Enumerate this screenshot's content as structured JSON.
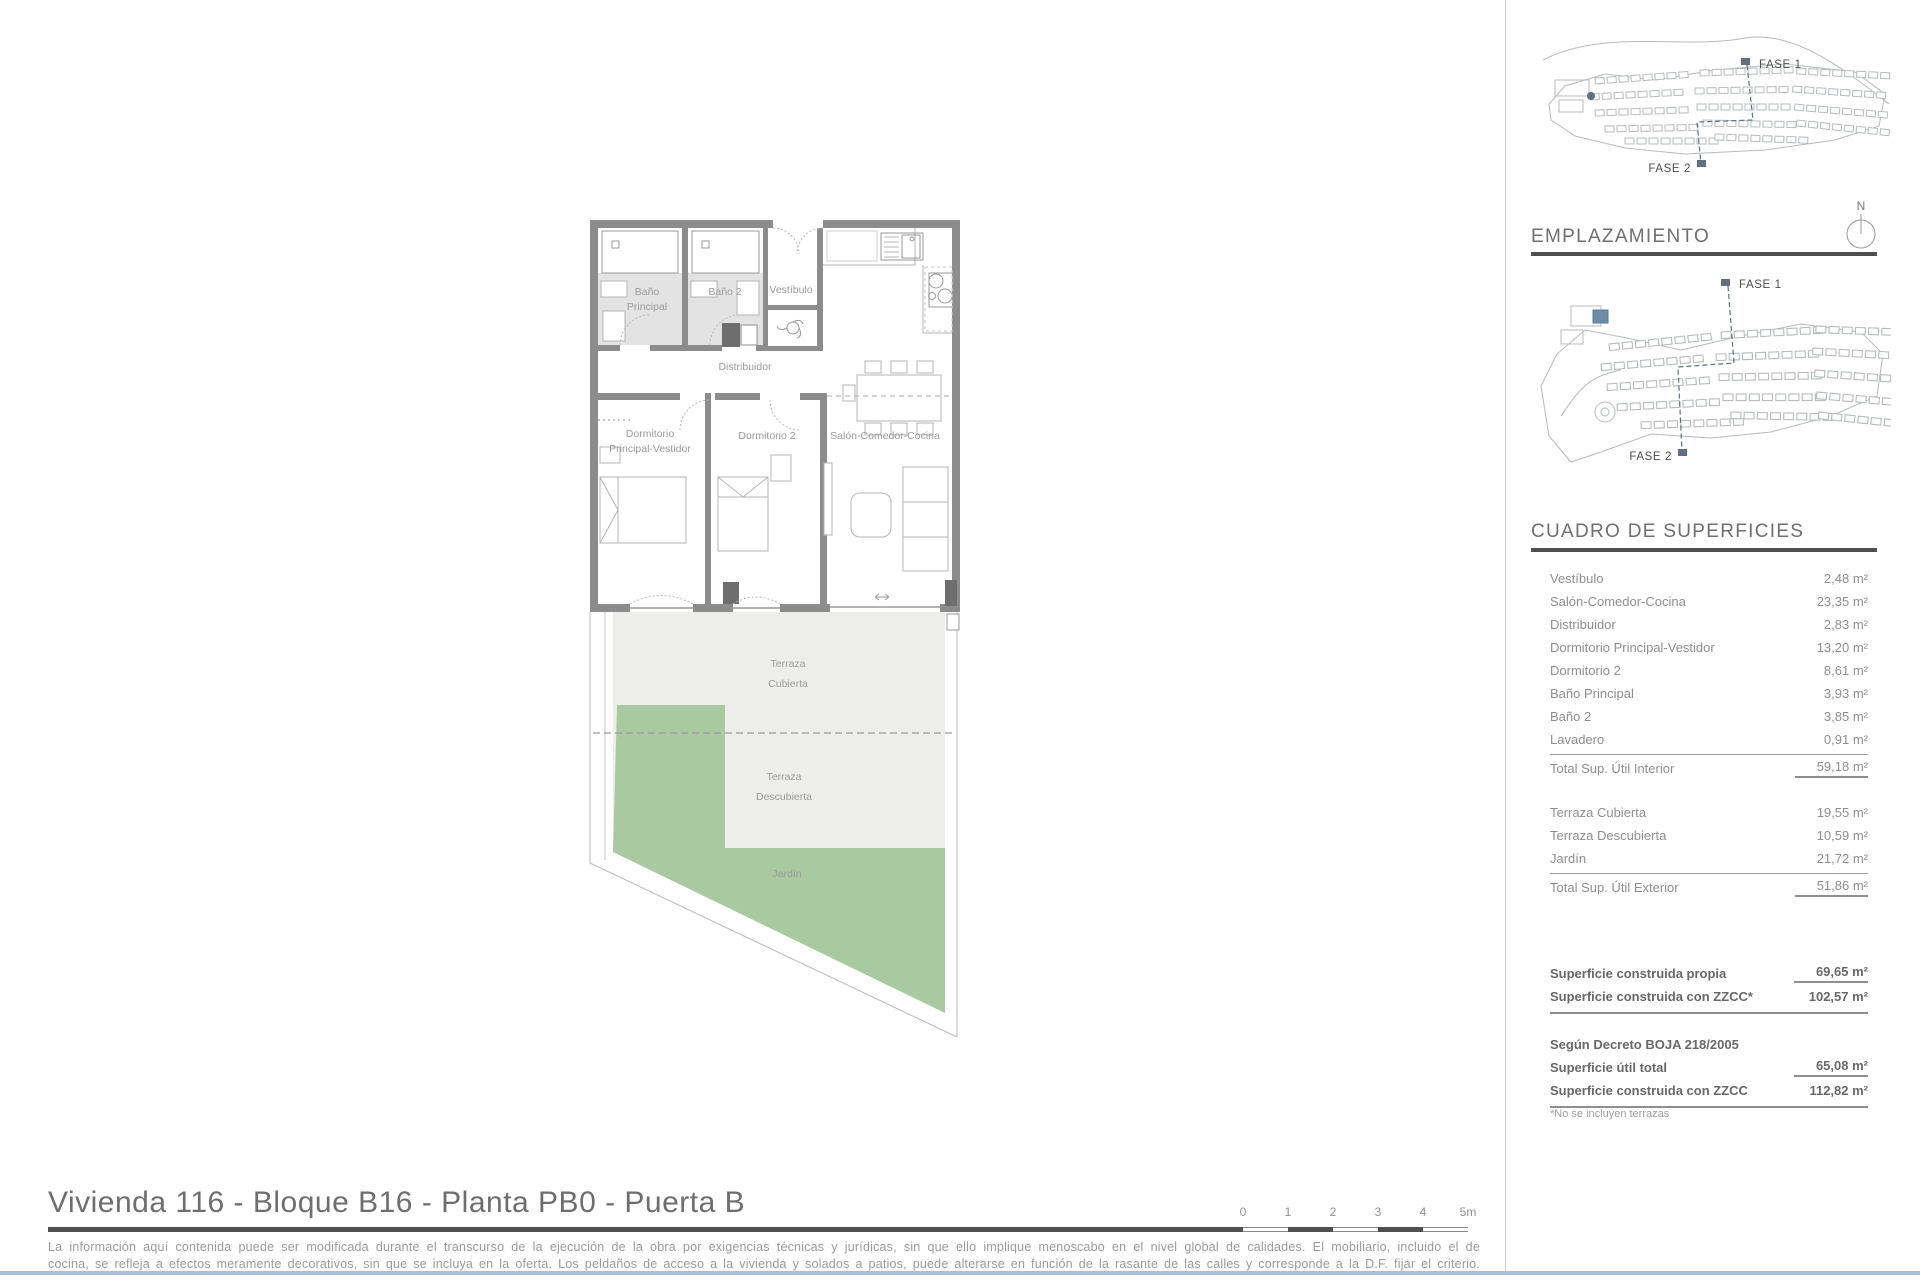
{
  "title": "Vivienda 116 - Bloque B16 - Planta PB0 - Puerta B",
  "disclaimer": {
    "line1": "La información aquí contenida puede ser modificada durante el transcurso de la ejecución de la obra por exigencias técnicas y jurídicas, sin que ello implique menoscabo en el nivel global de calidades. El mobiliario, incluido el de",
    "line2": "cocina, se refleja a efectos meramente decorativos, sin que se incluya en la oferta. Los peldaños de acceso a la vivienda y solados a patios, puede alterarse en función de la rasante de las calles y corresponde a la D.F. fijar el criterio."
  },
  "scale_bar": {
    "ticks": [
      "0",
      "1",
      "2",
      "3",
      "4",
      "5m"
    ]
  },
  "maps": {
    "emplazamiento_heading": "EMPLAZAMIENTO",
    "north_label": "N",
    "fase1_label": "FASE 1",
    "fase2_label": "FASE 2"
  },
  "superficies": {
    "heading": "CUADRO DE SUPERFICIES",
    "interior_rows": [
      {
        "label": "Vestíbulo",
        "value": "2,48 m²"
      },
      {
        "label": "Salón-Comedor-Cocina",
        "value": "23,35 m²"
      },
      {
        "label": "Distribuidor",
        "value": "2,83 m²"
      },
      {
        "label": "Dormitorio Principal-Vestidor",
        "value": "13,20 m²"
      },
      {
        "label": "Dormitorio 2",
        "value": "8,61 m²"
      },
      {
        "label": "Baño Principal",
        "value": "3,93 m²"
      },
      {
        "label": "Baño 2",
        "value": "3,85 m²"
      },
      {
        "label": "Lavadero",
        "value": "0,91 m²"
      }
    ],
    "interior_total": {
      "label": "Total Sup. Útil Interior",
      "value": "59,18 m²"
    },
    "exterior_rows": [
      {
        "label": "Terraza Cubierta",
        "value": "19,55 m²"
      },
      {
        "label": "Terraza Descubierta",
        "value": "10,59 m²"
      },
      {
        "label": "Jardín",
        "value": "21,72 m²"
      }
    ],
    "exterior_total": {
      "label": "Total Sup. Útil Exterior",
      "value": "51,86 m²"
    },
    "construida_rows": [
      {
        "label": "Superficie construida propia",
        "value": "69,65 m²"
      },
      {
        "label": "Superficie construida con ZZCC*",
        "value": "102,57 m²"
      }
    ],
    "decreto_heading": "Según Decreto BOJA 218/2005",
    "decreto_rows": [
      {
        "label": "Superficie útil total",
        "value": "65,08 m²"
      },
      {
        "label": "Superficie construida con ZZCC",
        "value": "112,82 m²"
      }
    ],
    "footnote": "*No se incluyen terrazas"
  },
  "floorplan": {
    "labels": {
      "bano_principal_l1": "Baño",
      "bano_principal_l2": "Principal",
      "bano2": "Baño 2",
      "vestibulo": "Vestíbulo",
      "distribuidor": "Distribuidor",
      "dormitorio_principal_l1": "Dormitorio",
      "dormitorio_principal_l2": "Principal-Vestidor",
      "dormitorio2": "Dormitorio 2",
      "salon": "Salón-Comedor-Cocina",
      "terraza_cubierta_l1": "Terraza",
      "terraza_cubierta_l2": "Cubierta",
      "terraza_descubierta_l1": "Terraza",
      "terraza_descubierta_l2": "Descubierta",
      "jardin": "Jardín"
    }
  },
  "colors": {
    "wall": "#8c8c8c",
    "bath_floor": "#e3e3e3",
    "terrace": "#edeeec",
    "garden": "#a9c9a1",
    "phase_marker": "#5f7081",
    "highlight_block": "#6e8ca3",
    "accent_dark": "#4f4f4f",
    "bottom_line": "#a7c0d6"
  }
}
